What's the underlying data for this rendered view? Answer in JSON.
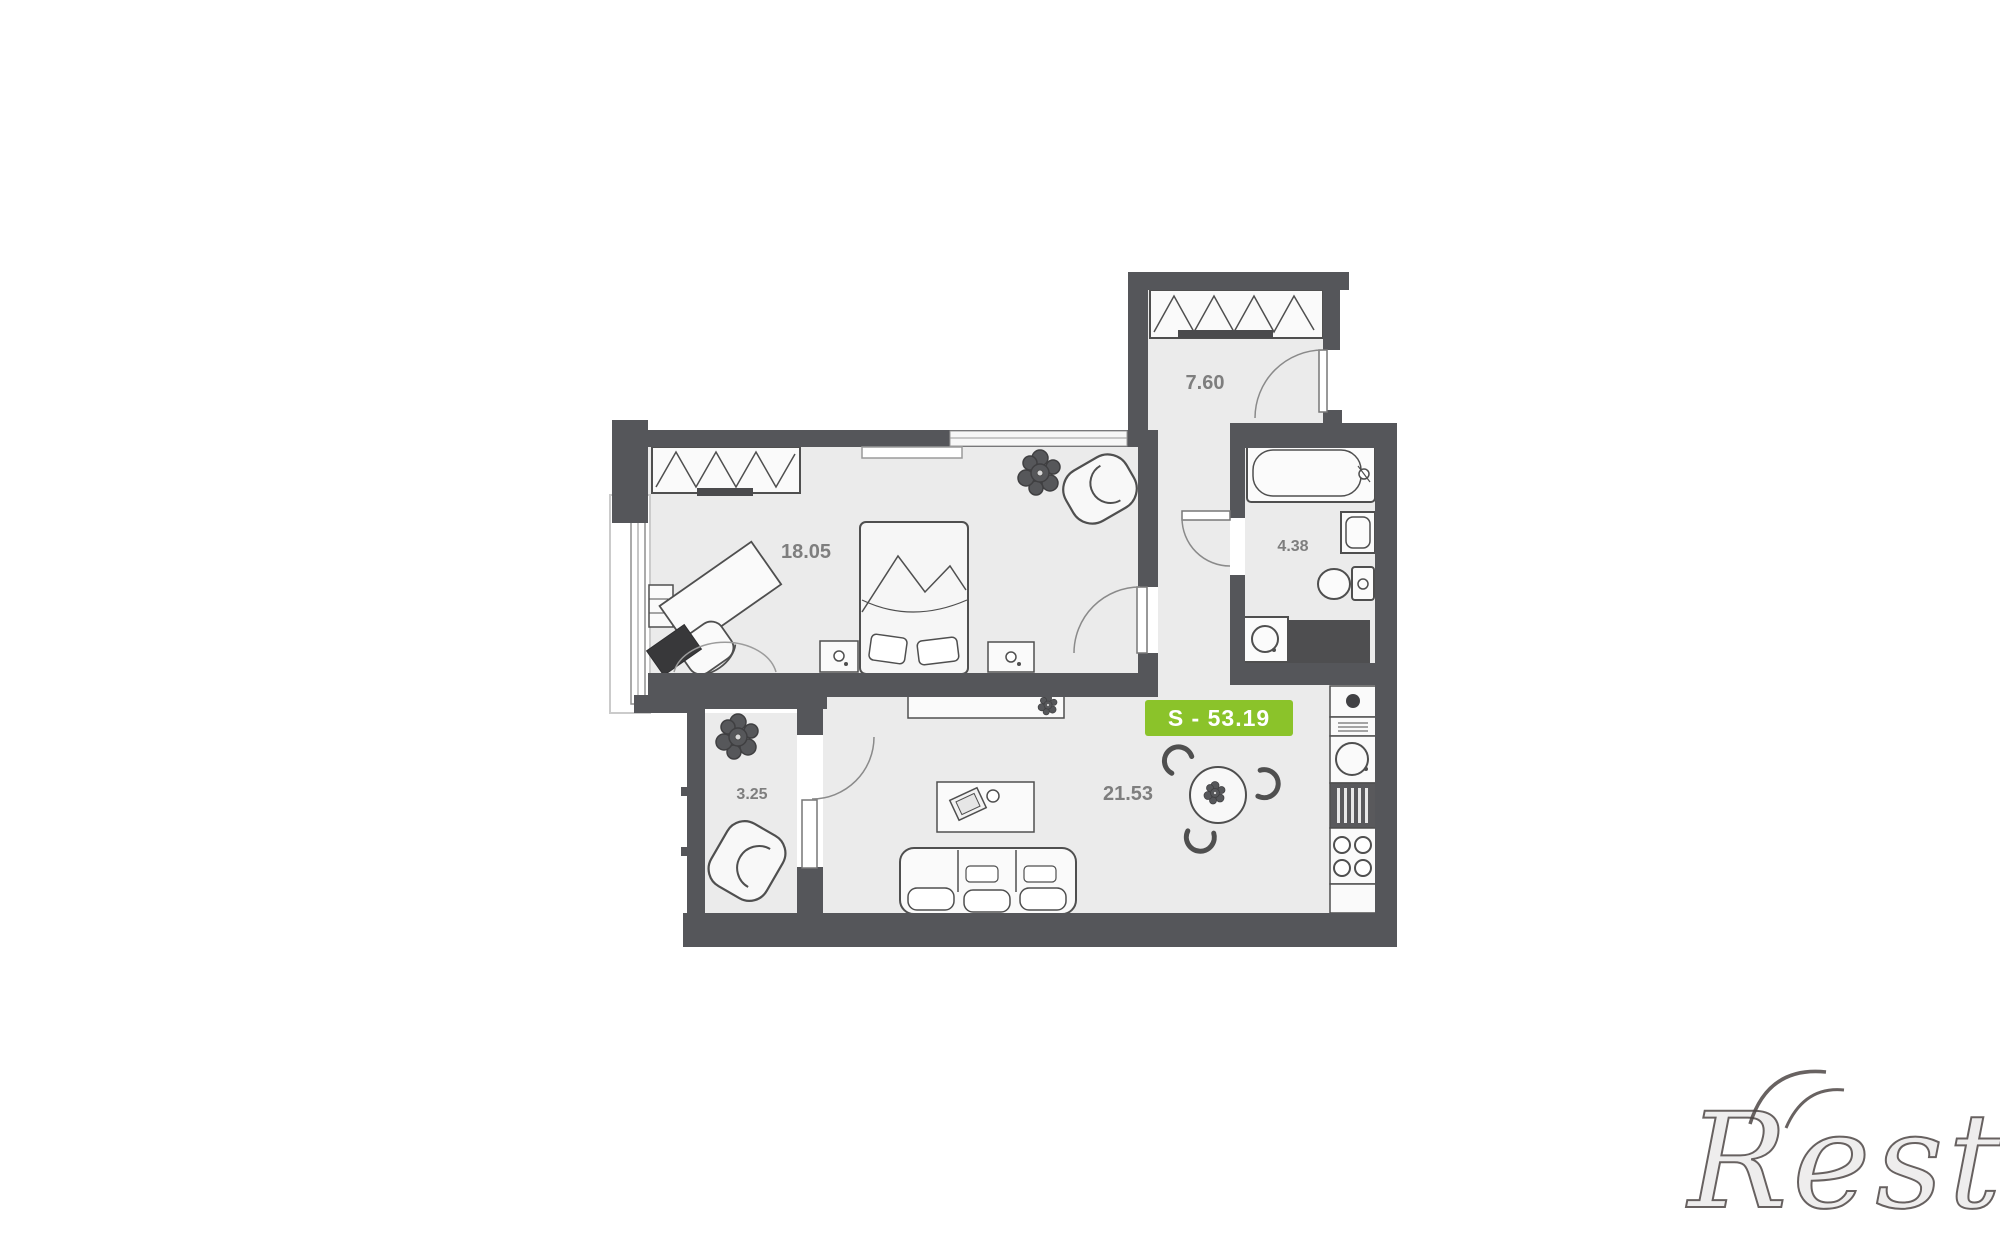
{
  "floor_plan": {
    "total_area_badge": "S - 53.19",
    "rooms": [
      {
        "name": "entrance-hall",
        "area": "7.60"
      },
      {
        "name": "bedroom",
        "area": "18.05"
      },
      {
        "name": "bathroom",
        "area": "4.38"
      },
      {
        "name": "hall",
        "area": "3.25"
      },
      {
        "name": "living-room-kitchen",
        "area": "21.53"
      }
    ],
    "watermark": "Restate",
    "colors": {
      "wall": "#55565a",
      "floor": "#ebebeb",
      "outline": "#4f4f4f",
      "badge_green": "#8bc32a",
      "badge_text": "#ffffff",
      "label_text": "#7e7e7e",
      "background": "#ffffff"
    }
  }
}
